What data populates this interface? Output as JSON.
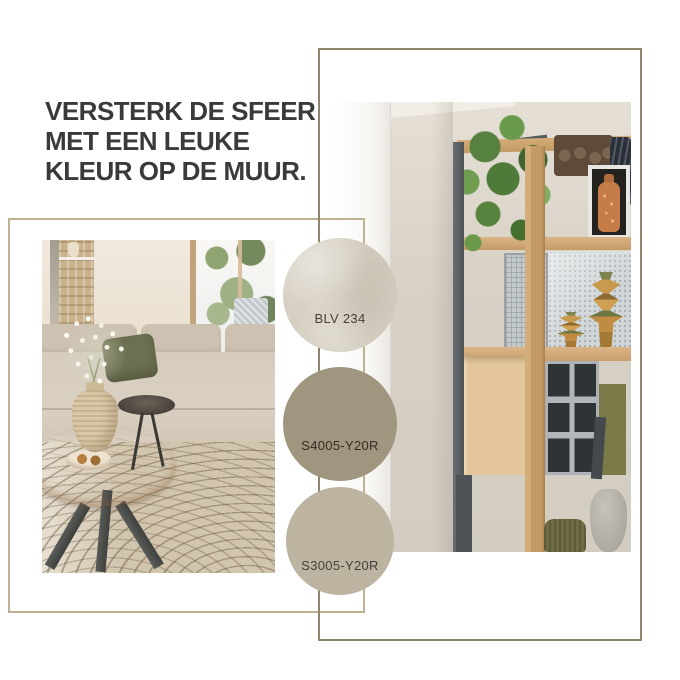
{
  "heading": {
    "lines": [
      "VERSTERK DE SFEER",
      "MET EEN LEUKE",
      "KLEUR OP DE MUUR."
    ],
    "color": "#3a3a3a"
  },
  "swatches": [
    {
      "label": "BLV 234",
      "color": "#d6cfc2",
      "label_color": "#45413a"
    },
    {
      "label": "S4005-Y20R",
      "color": "#a0957f",
      "label_color": "#342e24"
    },
    {
      "label": "S3005-Y20R",
      "color": "#bcb4a1",
      "label_color": "#45413a"
    }
  ],
  "frames": {
    "left_color": "#bfb294",
    "right_color": "#8e8468"
  }
}
